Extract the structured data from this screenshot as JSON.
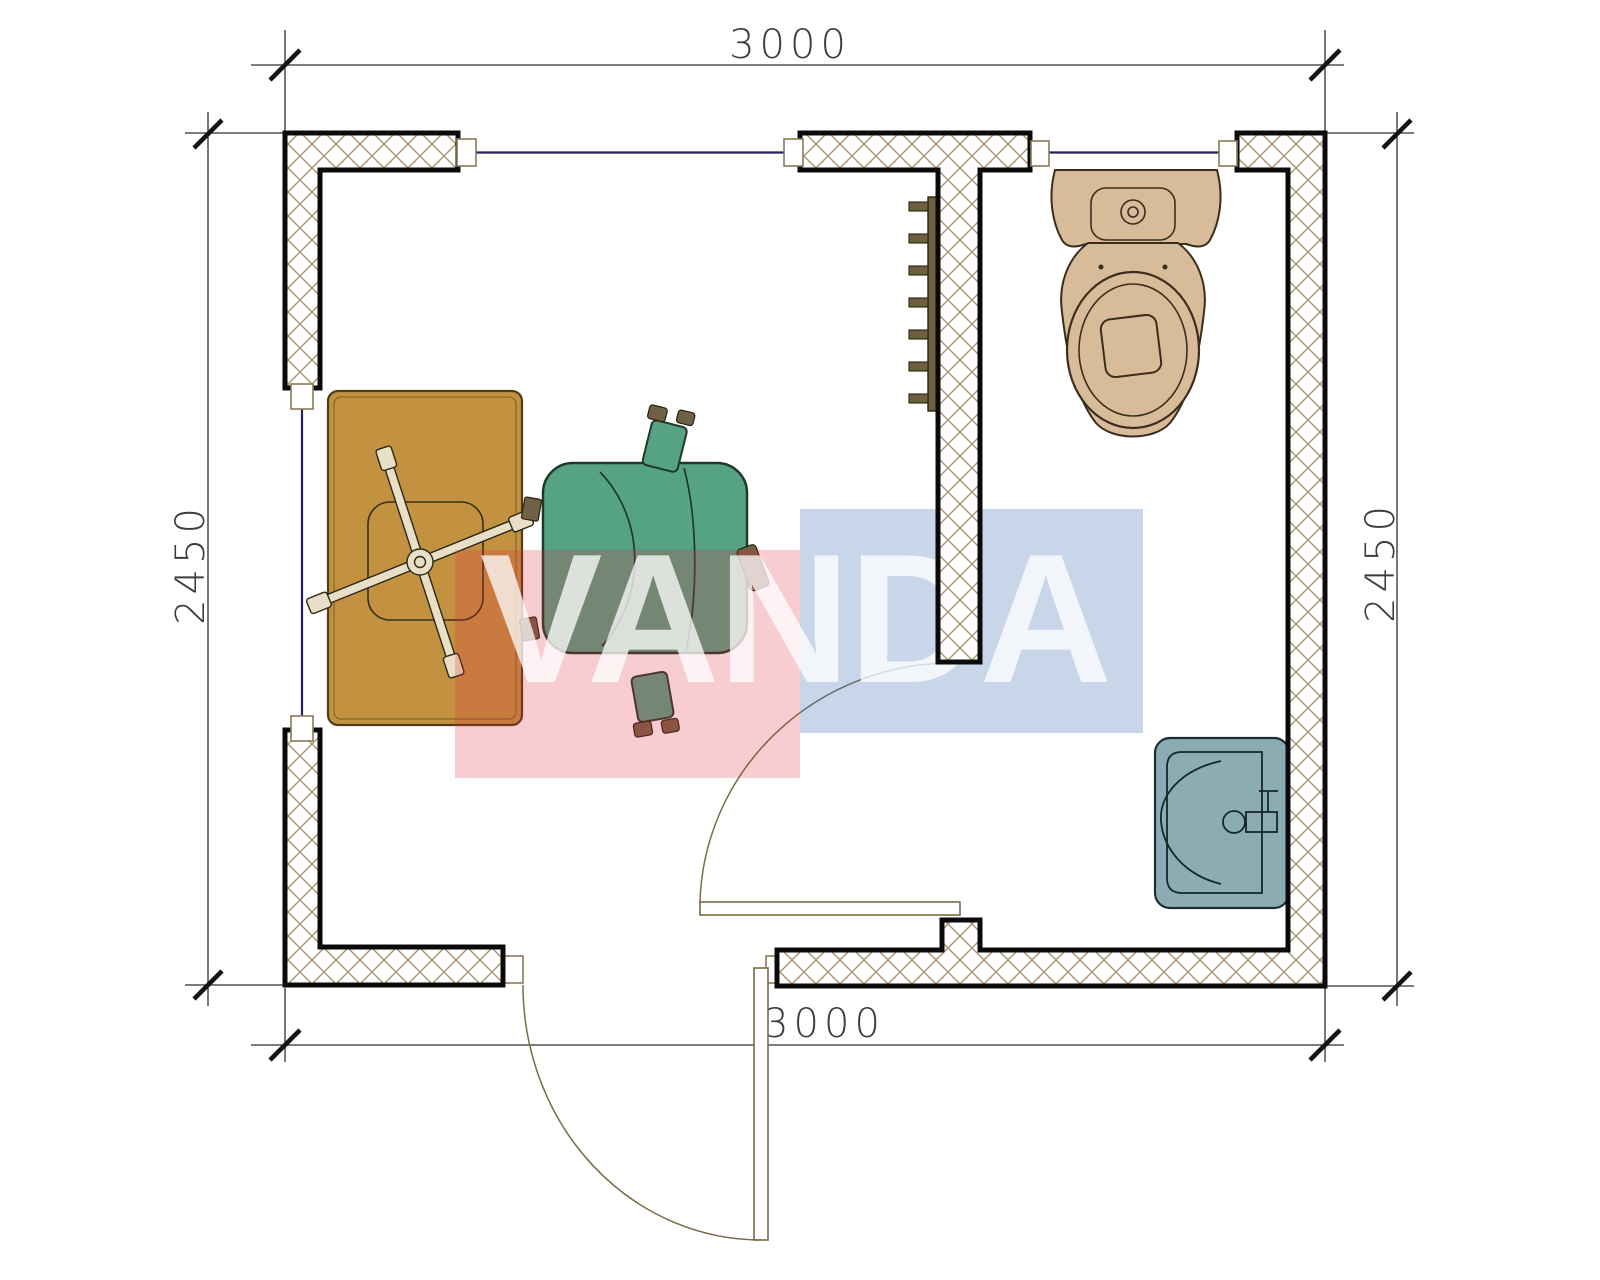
{
  "page": {
    "title": "Floor plan 3000 x 2450 cabin with office room and WC",
    "background": "#ffffff"
  },
  "dimensions": {
    "top": "3000",
    "bottom": "3000",
    "left": "2450",
    "right": "2450"
  },
  "watermark": {
    "text": "VANDA",
    "red_fill": "rgba(222,46,62,0.24)",
    "blue_fill": "rgba(70,110,180,0.29)",
    "text_fill": "rgba(255,255,255,0.75)"
  },
  "colors": {
    "wall_outline": "#0b0b0b",
    "wall_hatch": "#a6946e",
    "window_line": "#22225c",
    "door_line": "#7a6a48",
    "dimension_text": "#3d3d3d",
    "desk": "#c29240",
    "chair": "#55a285",
    "chair_tab": "#6f6046",
    "chair_base": "#e9dec6",
    "radiator": "#6f5f3e",
    "toilet": "#d8bc9a",
    "sink": "#8cacb4"
  },
  "fixtures": {
    "desk": "desk",
    "chair": "office-chair",
    "toilet": "toilet",
    "sink": "sink",
    "radiator": "radiator",
    "entry_door": "entry-door",
    "wc_door": "wc-door",
    "windows": "windows"
  }
}
